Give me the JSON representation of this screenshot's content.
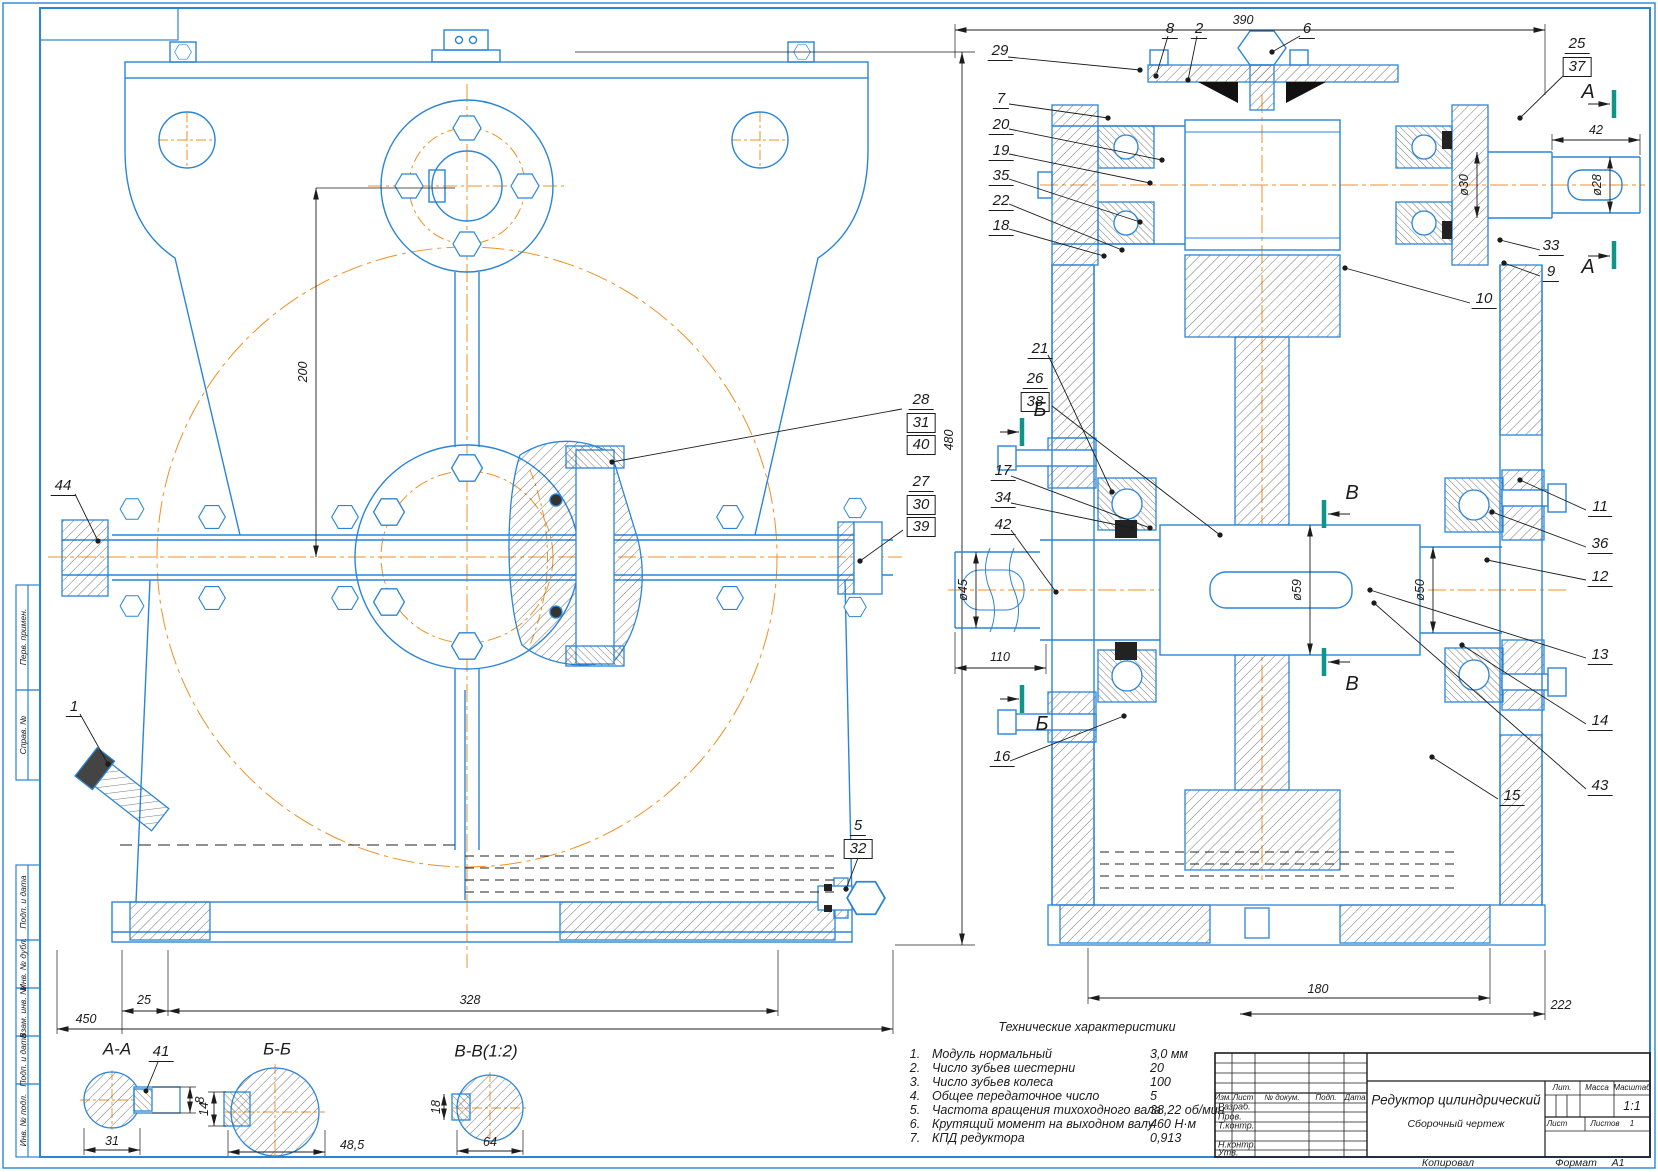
{
  "frame": {
    "side_labels": [
      "Перв. примен.",
      "Справ. №",
      "Подп. и дата",
      "Инв. № дубл.",
      "Взам. инв. №",
      "Подп. и дата",
      "Инв. № подл."
    ],
    "kopiroval": "Копировал",
    "format_label": "Формат",
    "format_value": "А1"
  },
  "views": {
    "front": {
      "dims": {
        "v200": "200",
        "v480": "480",
        "v25": "25",
        "v328": "328",
        "v450": "450"
      },
      "callouts": {
        "c44": "44",
        "c1": "1",
        "c5": "5",
        "c32": "32",
        "c28": "28",
        "c31": "31",
        "c40": "40",
        "c27": "27",
        "c30": "30",
        "c39": "39"
      }
    },
    "section": {
      "dims": {
        "v390": "390",
        "v42": "42",
        "d30": "ø30",
        "d28": "ø28",
        "d45": "ø45",
        "v110": "110",
        "d59": "ø59",
        "d50": "ø50",
        "v180": "180",
        "v222": "222"
      },
      "callouts": {
        "c29": "29",
        "c7": "7",
        "c20": "20",
        "c19": "19",
        "c35": "35",
        "c22": "22",
        "c18": "18",
        "c8": "8",
        "c2": "2",
        "c6": "6",
        "c25": "25",
        "c37": "37",
        "c33": "33",
        "c9": "9",
        "c10": "10",
        "c21": "21",
        "c26": "26",
        "c38": "38",
        "c17": "17",
        "c34": "34",
        "c42": "42",
        "c16": "16",
        "c11": "11",
        "c36": "36",
        "c12": "12",
        "c13": "13",
        "c14": "14",
        "c43": "43",
        "c15": "15"
      },
      "markers": {
        "a": "А",
        "b": "Б",
        "v": "В"
      }
    },
    "cuts": {
      "aa_label": "А-А",
      "c41": "41",
      "d8": "8",
      "d31": "31",
      "bb_label": "Б-Б",
      "d14": "14",
      "d48": "48,5",
      "vv_label": "В-В(1:2)",
      "d18": "18",
      "d64": "64"
    }
  },
  "tech": {
    "title": "Технические характеристики",
    "rows": [
      {
        "n": "1.",
        "t": "Модуль нормальный",
        "v": "3,0 мм"
      },
      {
        "n": "2.",
        "t": "Число зубьев шестерни",
        "v": "20"
      },
      {
        "n": "3.",
        "t": "Число зубьев колеса",
        "v": "100"
      },
      {
        "n": "4.",
        "t": "Общее передаточное число",
        "v": "5"
      },
      {
        "n": "5.",
        "t": "Частота вращения тихоходного вала",
        "v": "38,22 об/мин"
      },
      {
        "n": "6.",
        "t": "Крутящий момент на выходном валу",
        "v": "460 Н·м"
      },
      {
        "n": "7.",
        "t": "КПД редуктора",
        "v": "0,913"
      }
    ]
  },
  "title_block": {
    "cols": [
      "Изм.",
      "Лист",
      "№ докум.",
      "Подп.",
      "Дата"
    ],
    "rows": [
      "Разраб.",
      "Пров.",
      "Т.контр.",
      "Н.контр.",
      "Утв."
    ],
    "title": "Редуктор цилиндрический",
    "subtitle": "Сборочный чертеж",
    "lit": "Лит.",
    "mass": "Масса",
    "scale": "Масштаб",
    "scale_value": "1:1",
    "sheet": "Лист",
    "sheets": "Листов",
    "sheets_value": "1"
  },
  "colors": {
    "line": "#2a85d8",
    "center": "#f09022",
    "dim": "#1c1c1c",
    "marker": "#0e9488"
  }
}
